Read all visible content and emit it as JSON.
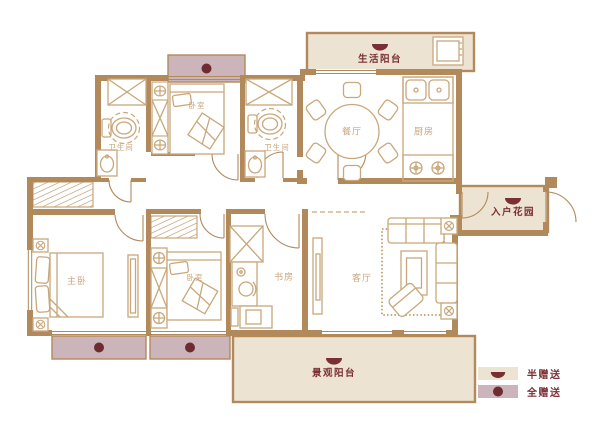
{
  "rooms": {
    "bath_a": "卫生间",
    "bedroom_top": "卧室",
    "bath_b": "卫生间",
    "dining": "餐厅",
    "kitchen": "厨房",
    "life_balcony": "生活阳台",
    "entry_garden": "入户花园",
    "master_bedroom": "主卧",
    "bedroom_b": "卧室",
    "study": "书房",
    "living_room": "客厅",
    "view_balcony": "景观阳台"
  },
  "legend": {
    "half_gift": "半赠送",
    "full_gift": "全赠送"
  },
  "colors": {
    "wall": "#B1895B",
    "furniture_line": "#C9A77B",
    "room_label": "#C8A57C",
    "accent_dark": "#7A2F33",
    "half_gift_fill": "#EDE3D3",
    "full_gift_fill": "#CBB4BA",
    "full_gift_dot": "#6E2B30",
    "background": "#FFFFFF"
  }
}
